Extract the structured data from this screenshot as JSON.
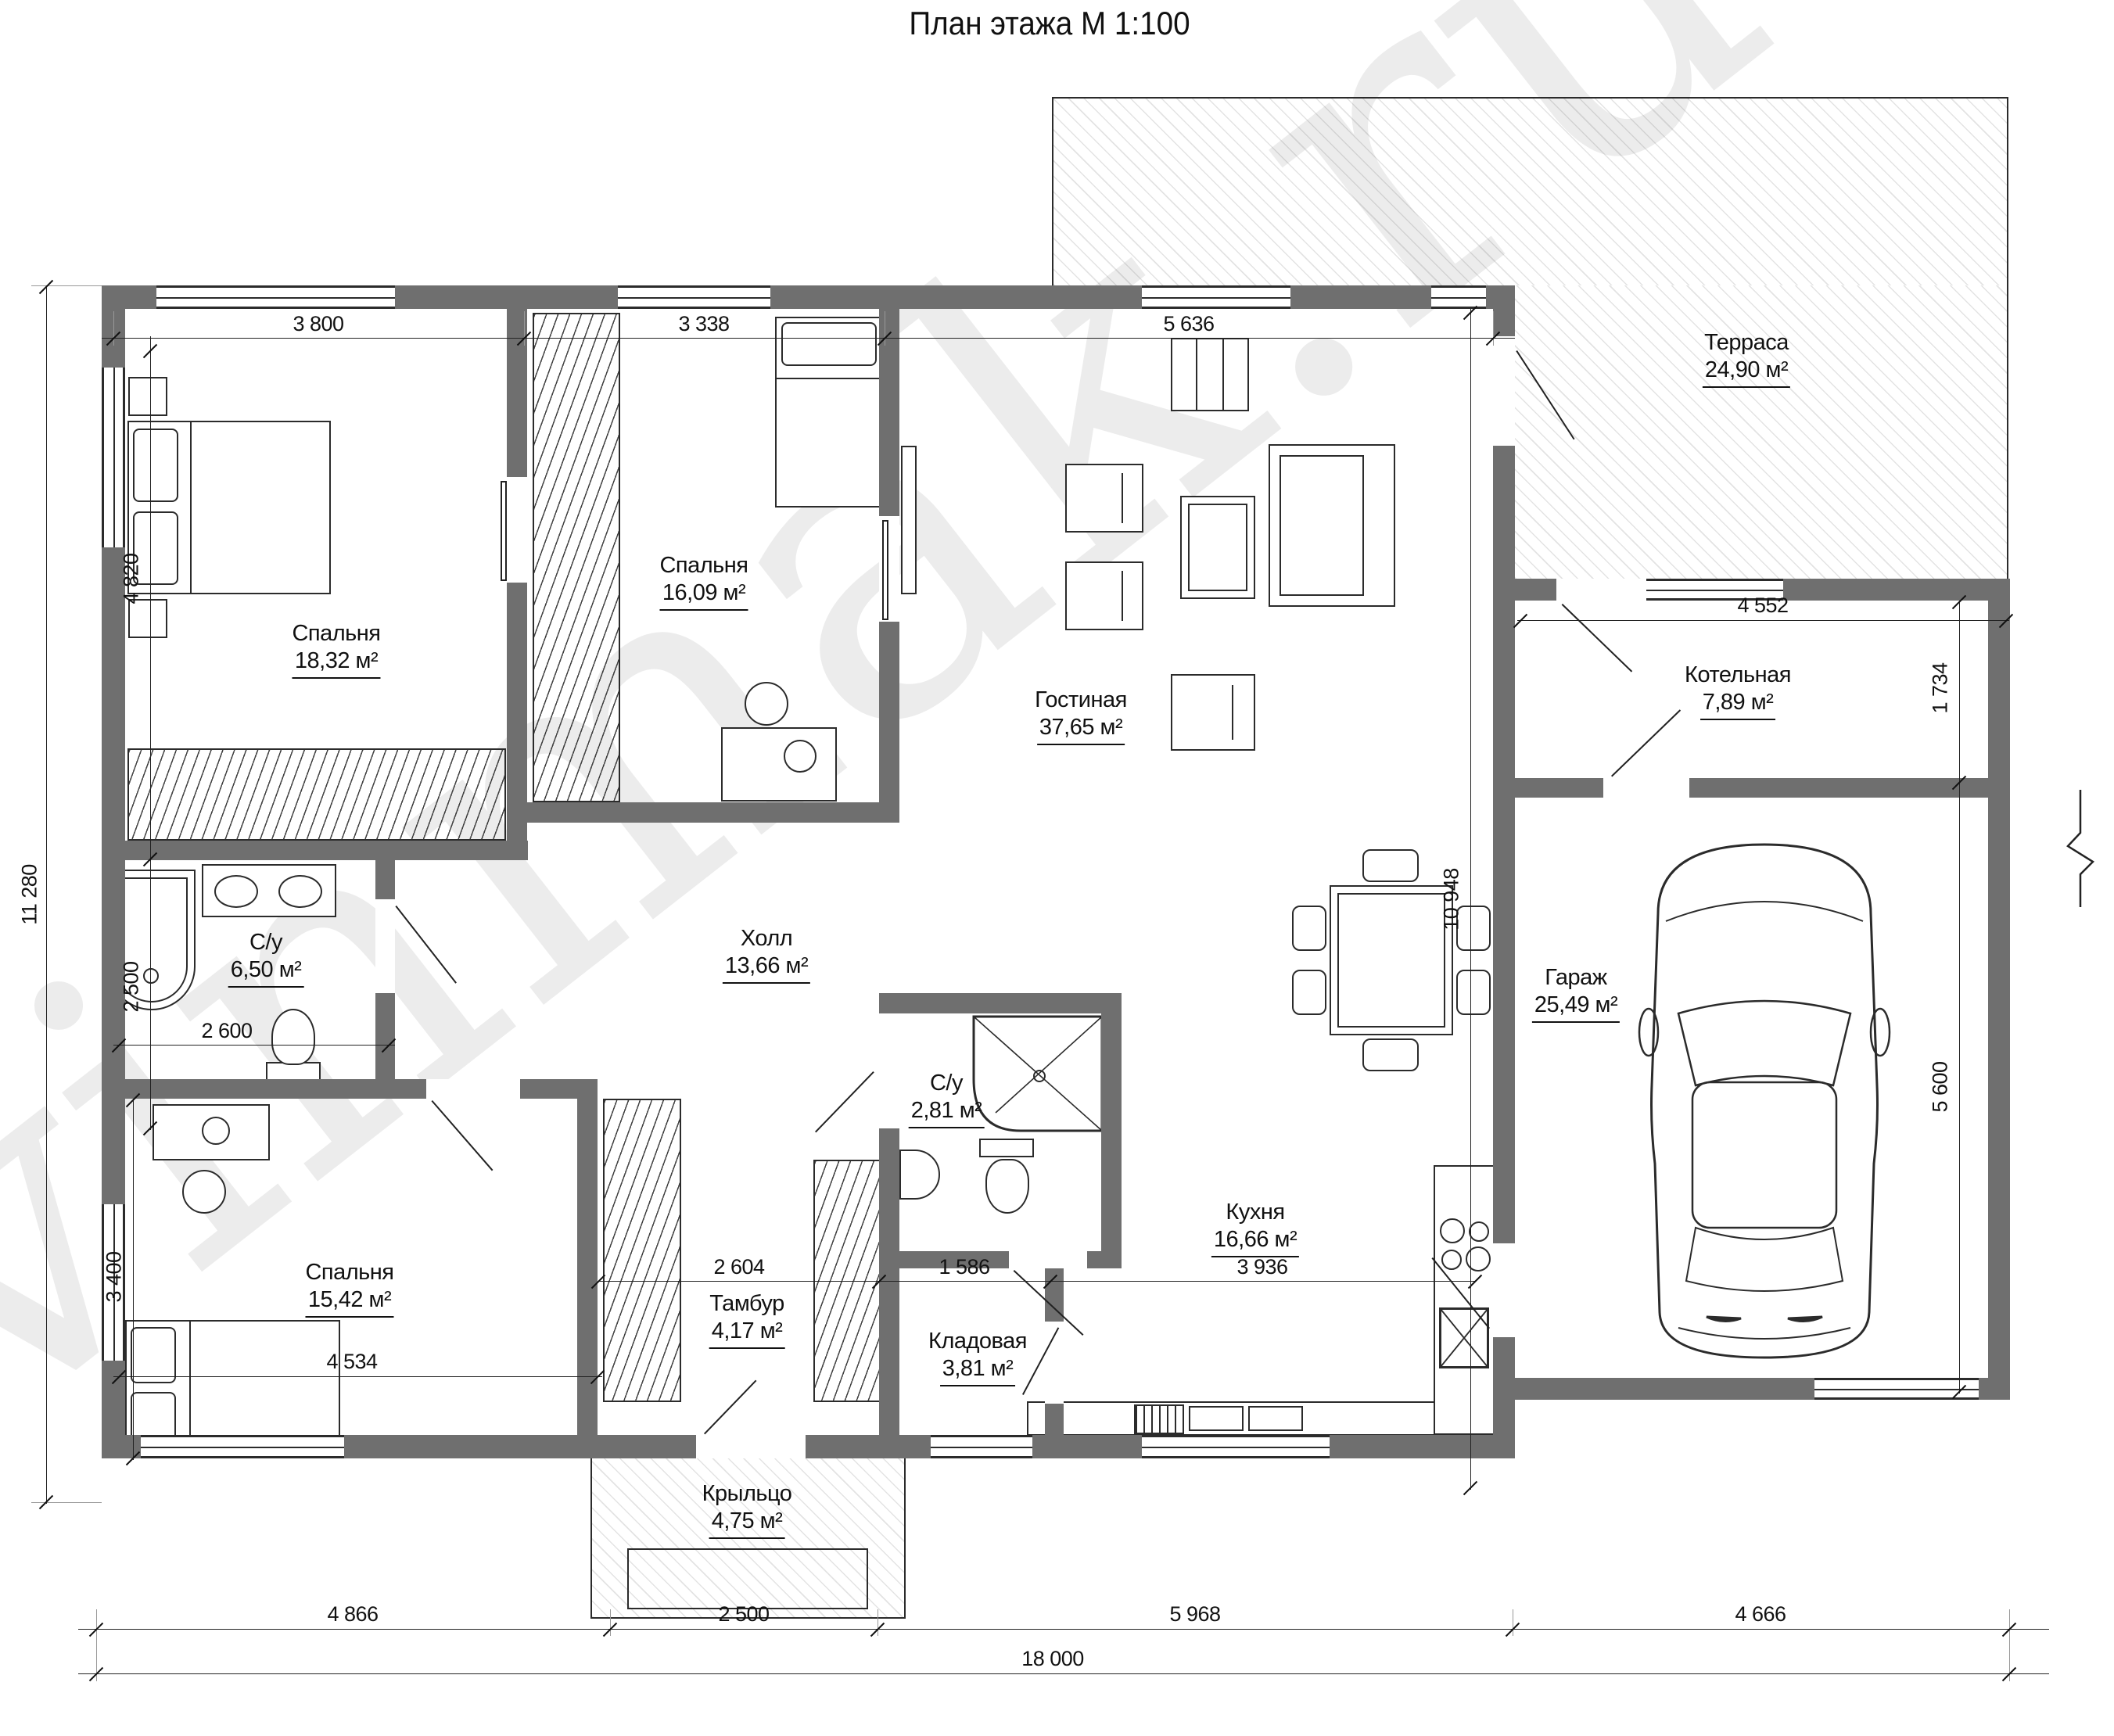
{
  "title": "План этажа М 1:100",
  "watermark": "vinmak.ru",
  "rooms": [
    {
      "name": "Спальня",
      "area": "18,32 м²"
    },
    {
      "name": "Спальня",
      "area": "16,09 м²"
    },
    {
      "name": "Гостиная",
      "area": "37,65 м²"
    },
    {
      "name": "Терраса",
      "area": "24,90 м²"
    },
    {
      "name": "Котельная",
      "area": "7,89 м²"
    },
    {
      "name": "Гараж",
      "area": "25,49 м²"
    },
    {
      "name": "С/у",
      "area": "6,50 м²"
    },
    {
      "name": "Холл",
      "area": "13,66 м²"
    },
    {
      "name": "С/у",
      "area": "2,81 м²"
    },
    {
      "name": "Спальня",
      "area": "15,42 м²"
    },
    {
      "name": "Тамбур",
      "area": "4,17 м²"
    },
    {
      "name": "Кладовая",
      "area": "3,81 м²"
    },
    {
      "name": "Кухня",
      "area": "16,66 м²"
    },
    {
      "name": "Крыльцо",
      "area": "4,75 м²"
    }
  ],
  "dimensions": {
    "top": [
      "3 800",
      "3 338",
      "5 636"
    ],
    "boiler_width": "4 552",
    "boiler_depth": "1 734",
    "garage_depth": "5 600",
    "left_total": "11 280",
    "bedroom_depth": "4 820",
    "bath_depth": "2 500",
    "bath_width": "2 600",
    "bedroom3_depth": "3 400",
    "bedroom3_width": "4 534",
    "tambour_width": "2 604",
    "closet_width": "1 586",
    "kitchen_width": "3 936",
    "inner_depth": "10 948",
    "bottom": [
      "4 866",
      "2 500",
      "5 968",
      "4 666"
    ],
    "total_width": "18 000"
  }
}
